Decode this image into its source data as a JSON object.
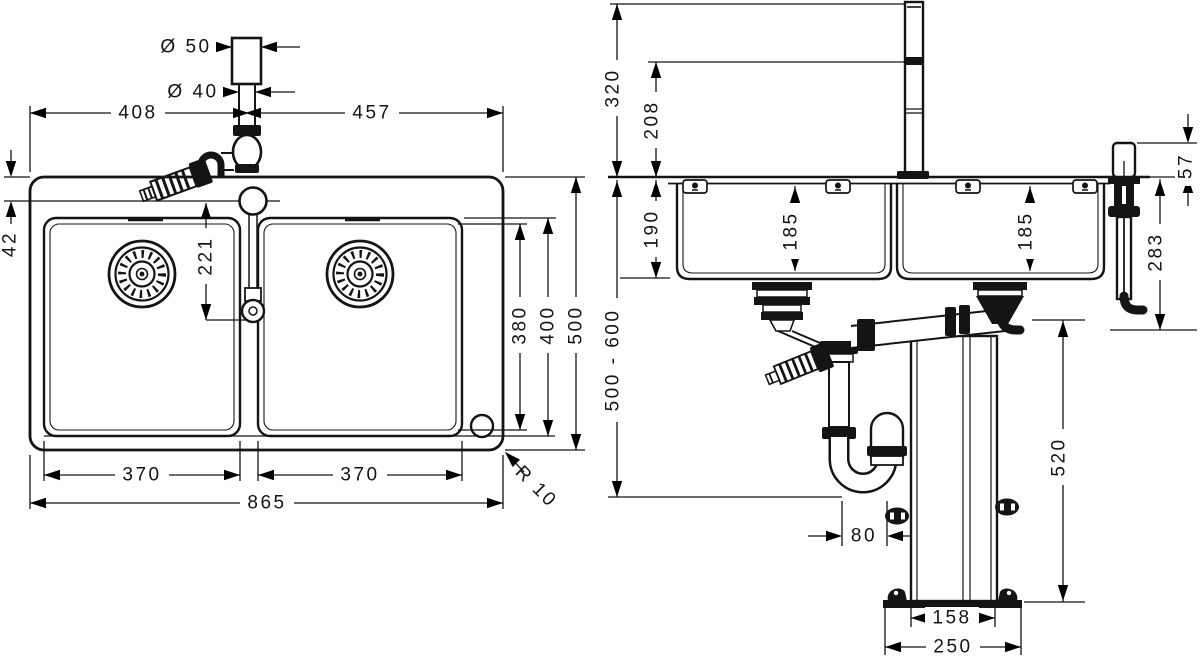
{
  "drawing": {
    "plan_view": {
      "faucet": {
        "spout_diameter": "Ø 50",
        "shaft_diameter": "Ø 40"
      },
      "dims": {
        "tap_from_left": "408",
        "tap_from_right": "457",
        "back_ledge": "42",
        "tap_to_connection": "221",
        "left_bowl_width": "370",
        "right_bowl_width": "370",
        "total_width": "865",
        "bowl_inner_length": "380",
        "bowl_outer_length": "400",
        "total_depth": "500",
        "corner_radius": "R 10"
      }
    },
    "front_view": {
      "dims": {
        "spout_top_height": "320",
        "spout_joint_height": "208",
        "bowl_depth_outer": "190",
        "left_bowl_inner_depth": "185",
        "right_bowl_inner_depth": "185",
        "dispenser_head_height": "57",
        "below_counter_depth": "283",
        "counter_height_range": "500 - 600",
        "column_height": "520",
        "trap_offset": "80",
        "column_width": "158",
        "base_plate_width": "250"
      }
    }
  }
}
